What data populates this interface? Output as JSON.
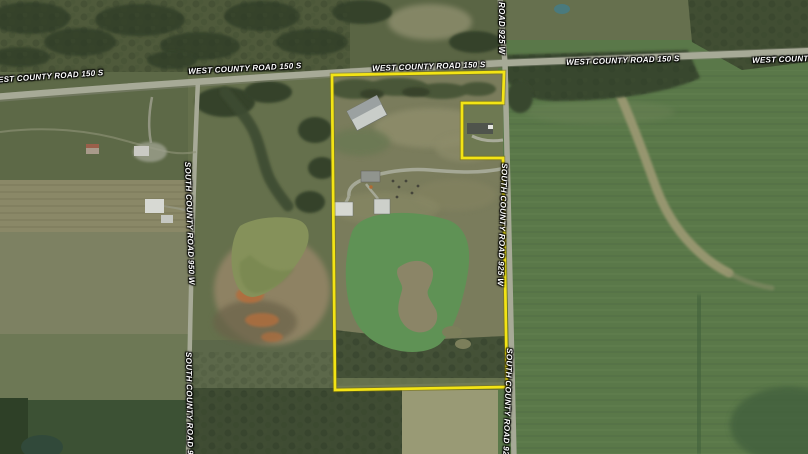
{
  "road_labels": {
    "west_county_road_150_s": "WEST COUNTY ROAD 150 S",
    "south_county_road_950_w": "SOUTH COUNTY ROAD 950 W",
    "south_county_road_925_w": "SOUTH COUNTY ROAD 925 W",
    "road_925_w": "ROAD 925 W"
  },
  "colors": {
    "parcel_boundary": "#f3e414",
    "road_surface": "#a7aa97",
    "road_label_text": "#ffffff",
    "pond_left": "#85915a",
    "pond_main": "#5f9255",
    "crop_field_east": "#5a7849",
    "tree_canopy": "#36422b",
    "quarry_orange": "#b26e3e",
    "small_pond_teal": "#4a7a7d"
  }
}
